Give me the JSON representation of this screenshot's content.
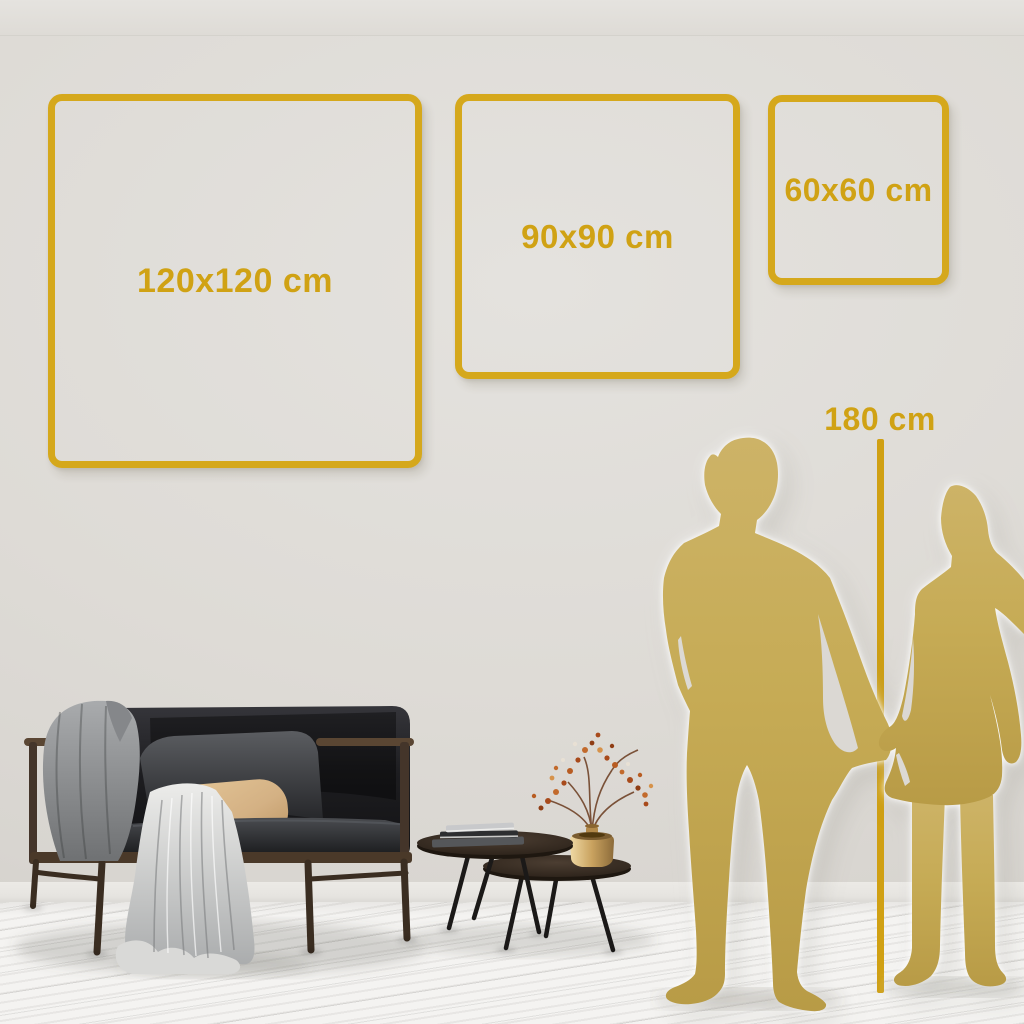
{
  "size_guide": {
    "frames": [
      {
        "id": "120x120",
        "label": "120x120 cm"
      },
      {
        "id": "90x90",
        "label": "90x90 cm"
      },
      {
        "id": "60x60",
        "label": "60x60 cm"
      }
    ],
    "height_reference": {
      "label": "180 cm"
    },
    "colors": {
      "accent_gold": "#D0A214",
      "frame_gold": "#D5A81C",
      "silhouette_gold": "#C7AC56",
      "wall": "#DEDBD6",
      "floor": "#F4F3F1",
      "sofa_charcoal": "#1C1D1F",
      "pillow_beige": "#D9BA8C",
      "vase_brass": "#C9A25F"
    },
    "illustrations": [
      "couple-silhouette",
      "sofa-with-blanket",
      "nesting-coffee-tables",
      "book-stack",
      "brass-vase-dried-flowers"
    ]
  }
}
